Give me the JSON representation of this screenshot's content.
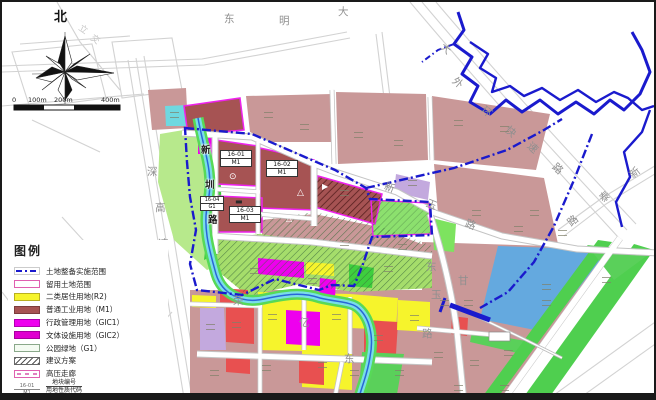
{
  "compass": {
    "north": "北"
  },
  "scale": {
    "ticks": [
      "0",
      "100m",
      "200m",
      "400m"
    ]
  },
  "legend": {
    "title": "图例",
    "items": [
      {
        "swatch": "boundary",
        "label": "土地整备实施范围"
      },
      {
        "swatch": "retained",
        "label": "留用土地范围"
      },
      {
        "swatch": "r2",
        "label": "二类居住用地(R2)"
      },
      {
        "swatch": "m1",
        "label": "普通工业用地（M1）"
      },
      {
        "swatch": "gic1",
        "label": "行政管理用地（GIC1）"
      },
      {
        "swatch": "gic2",
        "label": "文体设施用地（GIC2）"
      },
      {
        "swatch": "park",
        "label": "公园绿地（G1）"
      },
      {
        "swatch": "plan",
        "label": "建议方案"
      },
      {
        "swatch": "hv",
        "label": "高压走廊"
      }
    ],
    "code_item": {
      "example_top": "16-01",
      "example_bottom": "M1",
      "label_top": "地块编号",
      "label_bottom": "用地性质代码"
    }
  },
  "colors": {
    "boundary_blue": "#1a1acd",
    "retained_magenta": "#ee22ee",
    "r2_yellow": "#f6f42c",
    "m1_red": "#a65353",
    "gic_magenta": "#ee00ee",
    "park_green": "#8ce06e",
    "bright_green": "#3ecf3e",
    "river_cyan": "#79dde8",
    "lavender": "#c3a9de",
    "water_blue": "#64a9df",
    "mauve": "#c99898"
  },
  "map": {
    "road_labels": [
      {
        "t": "东",
        "x": 222,
        "y": 12
      },
      {
        "t": "明",
        "x": 277,
        "y": 14
      },
      {
        "t": "大",
        "x": 336,
        "y": 5
      },
      {
        "t": "大",
        "x": 438,
        "y": 42,
        "r": 40
      },
      {
        "t": "外",
        "x": 450,
        "y": 76,
        "r": 40
      },
      {
        "t": "环",
        "x": 479,
        "y": 105,
        "r": 40
      },
      {
        "t": "快",
        "x": 503,
        "y": 125,
        "r": 42
      },
      {
        "t": "速",
        "x": 525,
        "y": 141,
        "r": 42
      },
      {
        "t": "路",
        "x": 550,
        "y": 162,
        "r": 42
      },
      {
        "t": "新",
        "x": 628,
        "y": 166,
        "r": -40
      },
      {
        "t": "泰",
        "x": 598,
        "y": 190,
        "r": -40
      },
      {
        "t": "路",
        "x": 566,
        "y": 214,
        "r": -40
      },
      {
        "t": "新",
        "x": 382,
        "y": 181,
        "r": 22
      },
      {
        "t": "玉",
        "x": 424,
        "y": 198,
        "r": 22
      },
      {
        "t": "路",
        "x": 463,
        "y": 218,
        "r": 22
      },
      {
        "t": "深",
        "x": 145,
        "y": 165
      },
      {
        "t": "高",
        "x": 153,
        "y": 201
      },
      {
        "t": "速",
        "x": 156,
        "y": 237
      },
      {
        "t": "新",
        "x": 199,
        "y": 144,
        "d": 1
      },
      {
        "t": "圳",
        "x": 203,
        "y": 179,
        "d": 1
      },
      {
        "t": "路",
        "x": 206,
        "y": 214,
        "d": 1
      },
      {
        "t": "荣",
        "x": 231,
        "y": 294
      },
      {
        "t": "亿",
        "x": 297,
        "y": 316
      },
      {
        "t": "东",
        "x": 342,
        "y": 352
      },
      {
        "t": "东",
        "x": 424,
        "y": 260
      },
      {
        "t": "甘",
        "x": 456,
        "y": 274
      },
      {
        "t": "玉",
        "x": 429,
        "y": 288
      },
      {
        "t": "路",
        "x": 420,
        "y": 327
      },
      {
        "t": "立",
        "x": 76,
        "y": 24,
        "r": 35,
        "f": 1
      },
      {
        "t": "交",
        "x": 88,
        "y": 34,
        "r": 35,
        "f": 1
      }
    ],
    "parcel_labels": [
      {
        "code": "16-01",
        "use": "M1",
        "x": 218,
        "y": 148,
        "w": 30
      },
      {
        "code": "16-02",
        "use": "M1",
        "x": 264,
        "y": 158,
        "w": 30
      },
      {
        "code": "16-03",
        "use": "M1",
        "x": 227,
        "y": 204,
        "w": 30
      },
      {
        "code": "16-04",
        "use": "G1",
        "x": 198,
        "y": 194,
        "w": 22,
        "small": 1
      }
    ],
    "symbols": [
      {
        "t": "⊙",
        "x": 227,
        "y": 171,
        "c": "#ffffff",
        "s": 9
      },
      {
        "t": "▬",
        "x": 233,
        "y": 196,
        "c": "#2a2a2a",
        "s": 8
      },
      {
        "t": "△",
        "x": 295,
        "y": 187,
        "c": "#ffffff",
        "s": 9
      },
      {
        "t": "▶",
        "x": 320,
        "y": 181,
        "c": "#ffffff",
        "s": 8
      },
      {
        "t": "△",
        "x": 284,
        "y": 213,
        "c": "#ffffff",
        "s": 8
      }
    ],
    "marks": [
      [
        262,
        110
      ],
      [
        298,
        122
      ],
      [
        352,
        130
      ],
      [
        392,
        138
      ],
      [
        452,
        118
      ],
      [
        498,
        124
      ],
      [
        168,
        110
      ],
      [
        338,
        188
      ],
      [
        406,
        178
      ],
      [
        470,
        208
      ],
      [
        512,
        224
      ],
      [
        338,
        238
      ],
      [
        396,
        242
      ],
      [
        528,
        208
      ],
      [
        556,
        228
      ],
      [
        248,
        266
      ],
      [
        306,
        276
      ],
      [
        382,
        264
      ],
      [
        266,
        312
      ],
      [
        330,
        312
      ],
      [
        372,
        333
      ],
      [
        408,
        313
      ],
      [
        230,
        320
      ],
      [
        204,
        322
      ],
      [
        208,
        368
      ],
      [
        260,
        363
      ],
      [
        316,
        360
      ],
      [
        348,
        368
      ],
      [
        393,
        368
      ],
      [
        438,
        298
      ],
      [
        462,
        298
      ],
      [
        432,
        350
      ],
      [
        468,
        358
      ],
      [
        502,
        348
      ],
      [
        540,
        298
      ],
      [
        600,
        275
      ],
      [
        540,
        282
      ],
      [
        452,
        383
      ],
      [
        498,
        383
      ]
    ]
  }
}
